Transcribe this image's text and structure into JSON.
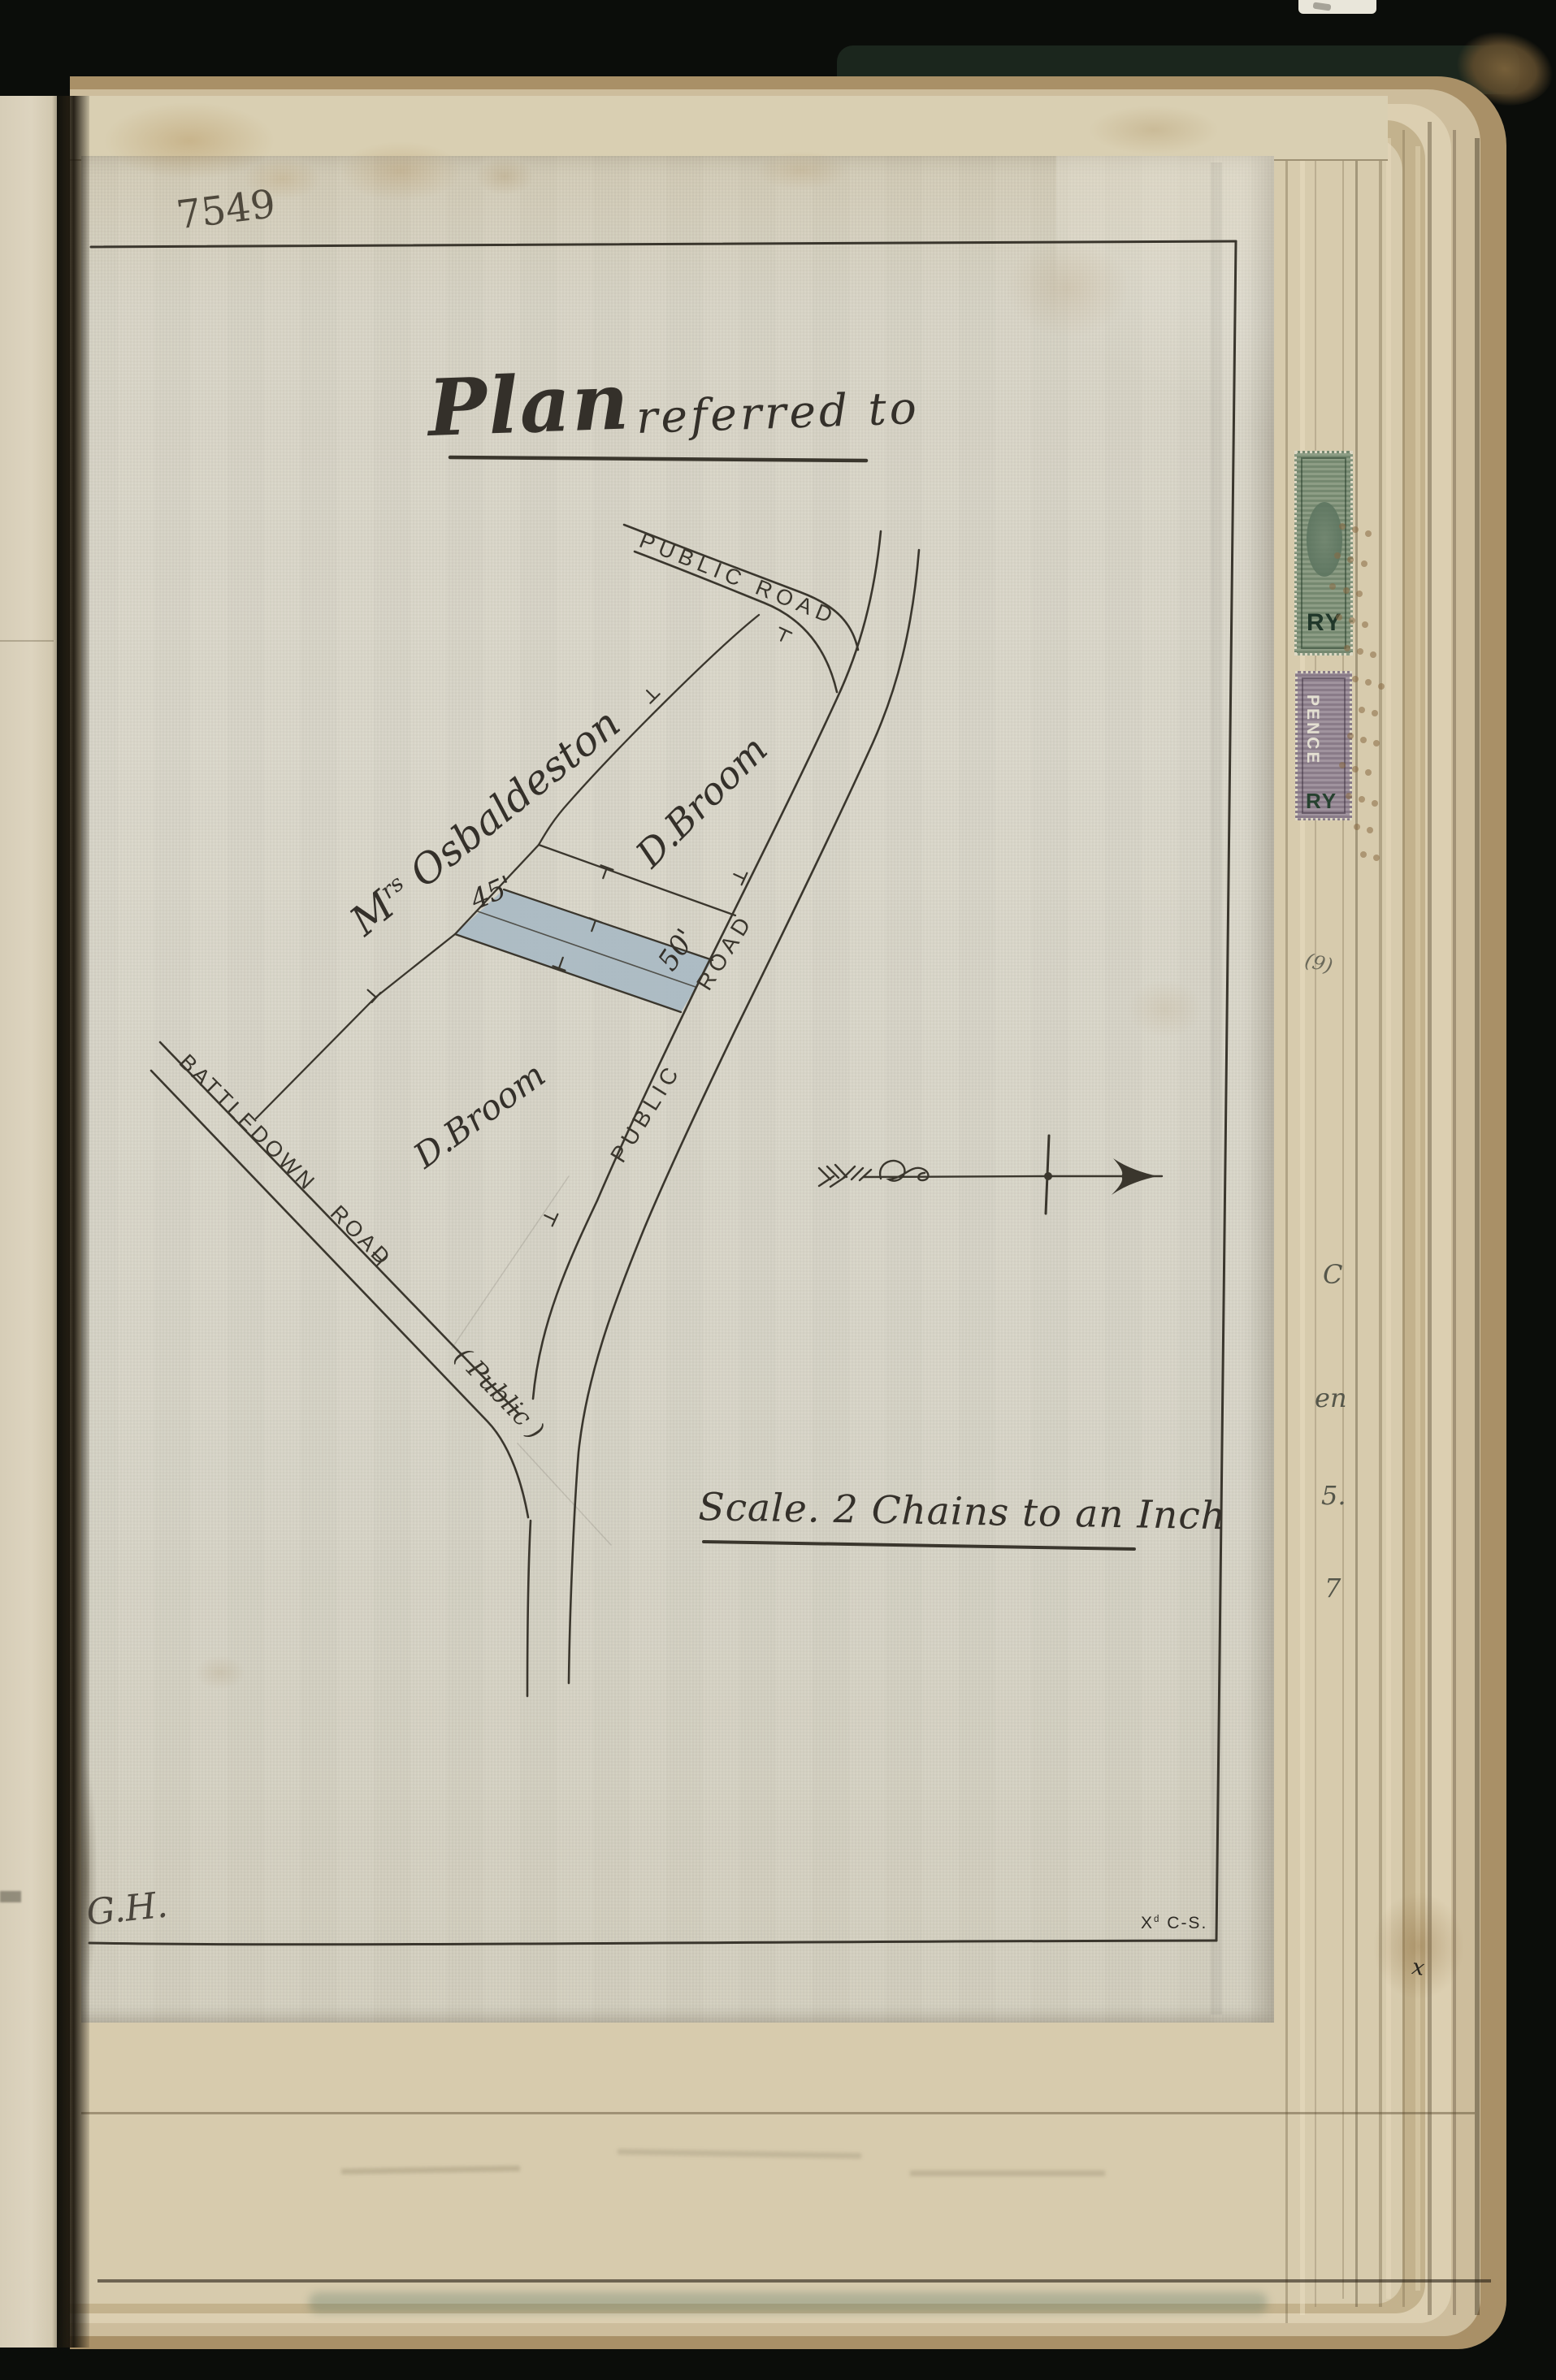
{
  "page": {
    "book_number": "7549",
    "title_word": "Plan",
    "title_rest": "referred to",
    "scale_note": "Scale. 2 Chains to an Inch",
    "surveyor_initials": "G.H.",
    "corner_mark_x": "X",
    "corner_mark_sup": "d",
    "corner_mark_rest": " C-S."
  },
  "map": {
    "roads": {
      "public_road_top": "PUBLIC ROAD",
      "public_road_main_word1": "PUBLIC",
      "public_road_main_word2": "ROAD",
      "battledown": "BATTLEDOWN ROAD",
      "battledown_suffix": "( Public )"
    },
    "owners": {
      "osbaldeston_m": "M",
      "osbaldeston_sup": "rs",
      "osbaldeston_rest": " Osbaldeston",
      "broom_upper": "D.Broom",
      "broom_lower": "D.Broom"
    },
    "parcel": {
      "width_label": "45'",
      "frontage_label": "50'",
      "fill_color": "#a9bac3"
    }
  },
  "stamps": {
    "green": {
      "fragment": "RY",
      "color": "#87987e"
    },
    "purple": {
      "word_vertical": "PENCE",
      "fragment": "RY",
      "color": "#9a8c98"
    }
  },
  "edge_fragments": {
    "f1": "(9)",
    "f2": "C",
    "f3": "en",
    "f4": "5.",
    "f5": "7",
    "f6": "x"
  },
  "colors": {
    "ink": "#3a362d",
    "pencil": "#4e483c",
    "plan_paper": "#d8d4c6",
    "page_edges": "#cdbd9c",
    "cover": "#10130d"
  }
}
